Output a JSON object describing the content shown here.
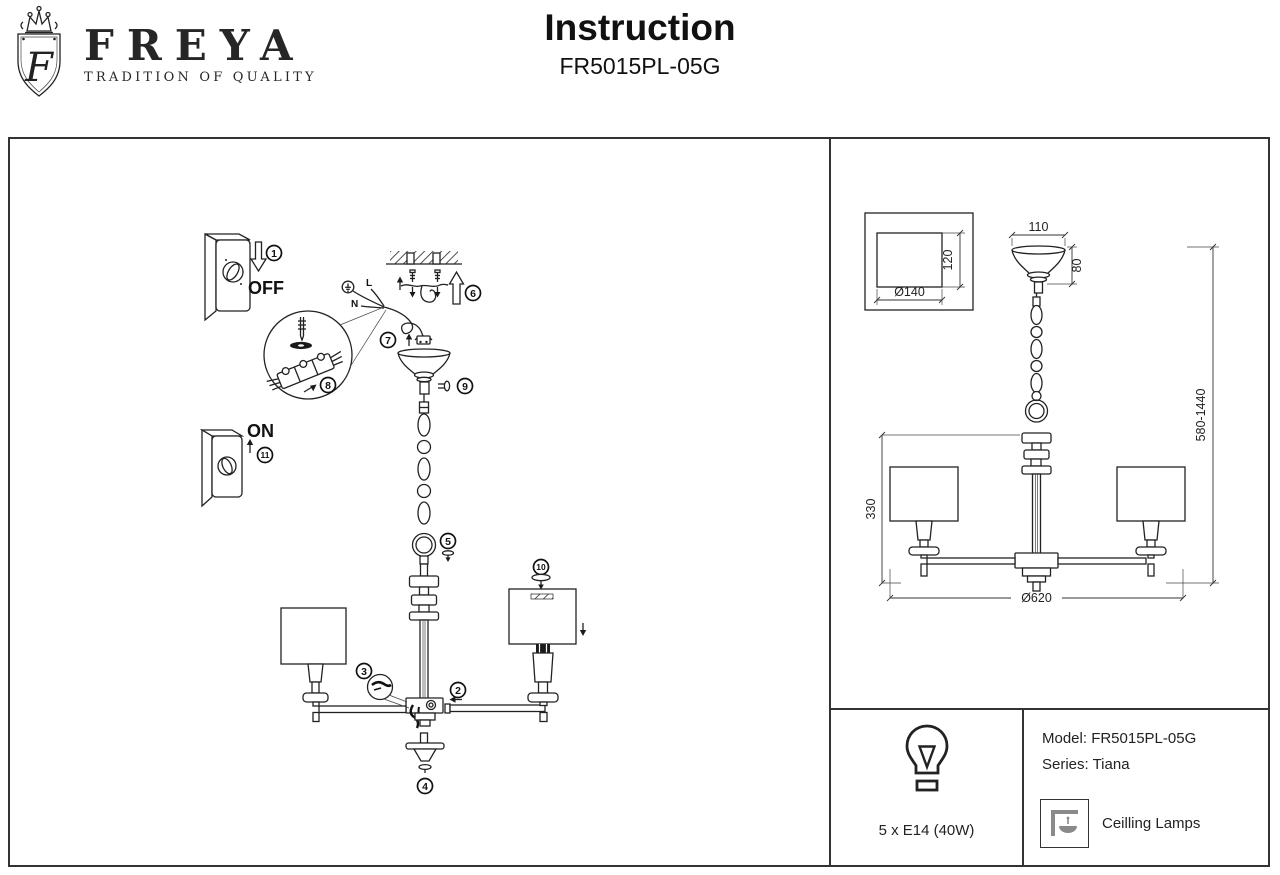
{
  "header": {
    "brand": "FREYA",
    "tagline": "TRADITION OF QUALITY",
    "logo_letter": "F",
    "title": "Instruction",
    "subtitle": "FR5015PL-05G"
  },
  "assembly": {
    "switch_off": "OFF",
    "switch_on": "ON",
    "wire_live": "L",
    "wire_neutral": "N",
    "steps": {
      "s1": "1",
      "s2": "2",
      "s3": "3",
      "s4": "4",
      "s5": "5",
      "s6": "6",
      "s7": "7",
      "s8": "8",
      "s9": "9",
      "s10": "10",
      "s11": "11"
    }
  },
  "dimensions": {
    "canopy_width": "110",
    "canopy_height": "80",
    "shade_top_height": "120",
    "shade_top_diameter": "Ø140",
    "body_height": "330",
    "hanging_height": "580-1440",
    "fixture_diameter": "Ø620"
  },
  "specs": {
    "bulbs": "5 x E14 (40W)",
    "model": "Model: FR5015PL-05G",
    "series": "Series: Tiana",
    "category": "Ceilling Lamps"
  }
}
